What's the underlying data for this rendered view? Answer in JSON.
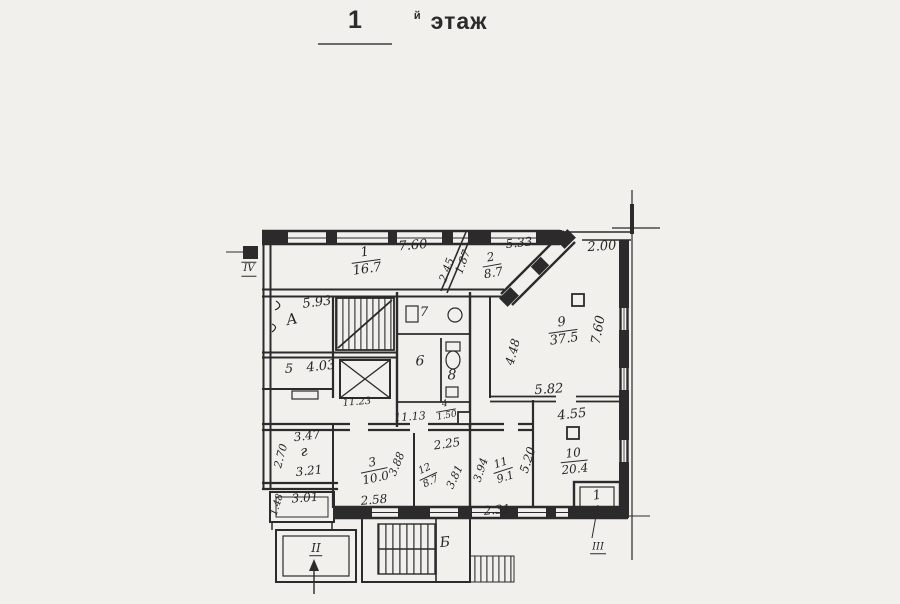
{
  "title": {
    "number": "1",
    "suffix": "й",
    "word": "этаж"
  },
  "colors": {
    "paper": "#f1f0ed",
    "ink": "#2b2b2b"
  },
  "plan": {
    "labels": [
      {
        "name": "dim-7-60-top",
        "text": "7.60",
        "x": 413,
        "y": 246,
        "rot": -5,
        "fs": 13
      },
      {
        "name": "room-1-area-label",
        "top": "1",
        "bottom": "16.7",
        "x": 366,
        "y": 261,
        "rot": -8,
        "fs": 13
      },
      {
        "name": "dim-2-45",
        "text": "2.45",
        "x": 447,
        "y": 270,
        "rot": -70,
        "fs": 11
      },
      {
        "name": "dim-1-87",
        "text": "1.87",
        "x": 463,
        "y": 262,
        "rot": -70,
        "fs": 11
      },
      {
        "name": "dim-5-33",
        "text": "5.33",
        "x": 519,
        "y": 243,
        "rot": -6,
        "fs": 12
      },
      {
        "name": "room-2-area-label",
        "top": "2",
        "bottom": "8.7",
        "x": 492,
        "y": 265,
        "rot": -10,
        "fs": 12
      },
      {
        "name": "dim-2-00",
        "text": "2.00",
        "x": 602,
        "y": 247,
        "rot": -4,
        "fs": 13
      },
      {
        "name": "dim-5-93",
        "text": "5.93",
        "x": 317,
        "y": 303,
        "rot": -7,
        "fs": 13
      },
      {
        "name": "stairwell-a-label",
        "text": "А",
        "x": 292,
        "y": 320,
        "rot": -12,
        "fs": 15
      },
      {
        "name": "room-5-number",
        "text": "5",
        "x": 289,
        "y": 370,
        "rot": 0,
        "fs": 13
      },
      {
        "name": "dim-4-03",
        "text": "4.03",
        "x": 321,
        "y": 367,
        "rot": -6,
        "fs": 13
      },
      {
        "name": "area-11-23",
        "text": "11.23",
        "x": 357,
        "y": 403,
        "rot": -4,
        "fs": 10
      },
      {
        "name": "area-11-13",
        "text": "11.13",
        "x": 410,
        "y": 417,
        "rot": -4,
        "fs": 11
      },
      {
        "name": "room-4-area-label",
        "top": "4",
        "bottom": "1.50",
        "x": 446,
        "y": 411,
        "rot": -10,
        "fs": 9
      },
      {
        "name": "room-7-number",
        "text": "7",
        "x": 424,
        "y": 313,
        "rot": 0,
        "fs": 13
      },
      {
        "name": "room-6-number",
        "text": "6",
        "x": 420,
        "y": 362,
        "rot": 0,
        "fs": 14
      },
      {
        "name": "room-8-number",
        "text": "8",
        "x": 452,
        "y": 376,
        "rot": 0,
        "fs": 14
      },
      {
        "name": "room-9-area-label",
        "top": "9",
        "bottom": "37.5",
        "x": 563,
        "y": 331,
        "rot": -8,
        "fs": 13
      },
      {
        "name": "dim-7-60-right",
        "text": "7.60",
        "x": 599,
        "y": 330,
        "rot": -80,
        "fs": 13
      },
      {
        "name": "dim-4-48",
        "text": "4.48",
        "x": 513,
        "y": 352,
        "rot": -75,
        "fs": 12
      },
      {
        "name": "dim-5-82",
        "text": "5.82",
        "x": 549,
        "y": 390,
        "rot": -4,
        "fs": 13
      },
      {
        "name": "dim-4-55",
        "text": "4.55",
        "x": 572,
        "y": 415,
        "rot": -6,
        "fs": 13
      },
      {
        "name": "room-10-area-label",
        "top": "10",
        "bottom": "20.4",
        "x": 574,
        "y": 461,
        "rot": -6,
        "fs": 12
      },
      {
        "name": "dim-5-20",
        "text": "5.20",
        "x": 528,
        "y": 460,
        "rot": -72,
        "fs": 12
      },
      {
        "name": "room-11-area-label",
        "top": "11",
        "bottom": "9.1",
        "x": 503,
        "y": 470,
        "rot": -18,
        "fs": 11
      },
      {
        "name": "dim-3-94",
        "text": "3.94",
        "x": 481,
        "y": 470,
        "rot": -72,
        "fs": 11
      },
      {
        "name": "dim-2-31",
        "text": "2.31",
        "x": 497,
        "y": 510,
        "rot": -5,
        "fs": 12
      },
      {
        "name": "dim-2-25",
        "text": "2.25",
        "x": 447,
        "y": 444,
        "rot": -8,
        "fs": 12
      },
      {
        "name": "room-12-area-label",
        "top": "12",
        "bottom": "8.7",
        "x": 428,
        "y": 476,
        "rot": -25,
        "fs": 10
      },
      {
        "name": "dim-3-81",
        "text": "3.81",
        "x": 455,
        "y": 477,
        "rot": -65,
        "fs": 11
      },
      {
        "name": "room-3-area-label",
        "top": "3",
        "bottom": "10.0",
        "x": 374,
        "y": 470,
        "rot": -12,
        "fs": 12
      },
      {
        "name": "dim-3-88",
        "text": "3.88",
        "x": 397,
        "y": 464,
        "rot": -68,
        "fs": 11
      },
      {
        "name": "dim-2-58",
        "text": "2.58",
        "x": 374,
        "y": 500,
        "rot": -5,
        "fs": 12
      },
      {
        "name": "dim-3-47",
        "text": "3.47",
        "x": 307,
        "y": 436,
        "rot": -7,
        "fs": 12
      },
      {
        "name": "room-g-label",
        "text": "г",
        "x": 304,
        "y": 452,
        "rot": -10,
        "fs": 14
      },
      {
        "name": "dim-2-70",
        "text": "2.70",
        "x": 281,
        "y": 456,
        "rot": -75,
        "fs": 11
      },
      {
        "name": "dim-3-21",
        "text": "3.21",
        "x": 309,
        "y": 471,
        "rot": -6,
        "fs": 12
      },
      {
        "name": "dim-3-01",
        "text": "3.01",
        "x": 305,
        "y": 498,
        "rot": -4,
        "fs": 12
      },
      {
        "name": "dim-1-48",
        "text": "1.48",
        "x": 278,
        "y": 505,
        "rot": -73,
        "fs": 10
      },
      {
        "name": "entrance-iv-label",
        "text": "IV",
        "x": 249,
        "y": 269,
        "rot": 0,
        "fs": 10,
        "cls": "roman-both"
      },
      {
        "name": "entrance-ii-label",
        "text": "II",
        "x": 316,
        "y": 549,
        "rot": 0,
        "fs": 12,
        "cls": "roman-under"
      },
      {
        "name": "entrance-iii-label",
        "text": "III",
        "x": 598,
        "y": 548,
        "rot": 0,
        "fs": 10,
        "cls": "roman-under"
      },
      {
        "name": "stairwell-b-label",
        "text": "Б",
        "x": 445,
        "y": 543,
        "rot": -6,
        "fs": 14
      },
      {
        "name": "porch-1-label",
        "text": "1",
        "x": 597,
        "y": 496,
        "rot": -8,
        "fs": 13
      }
    ]
  }
}
